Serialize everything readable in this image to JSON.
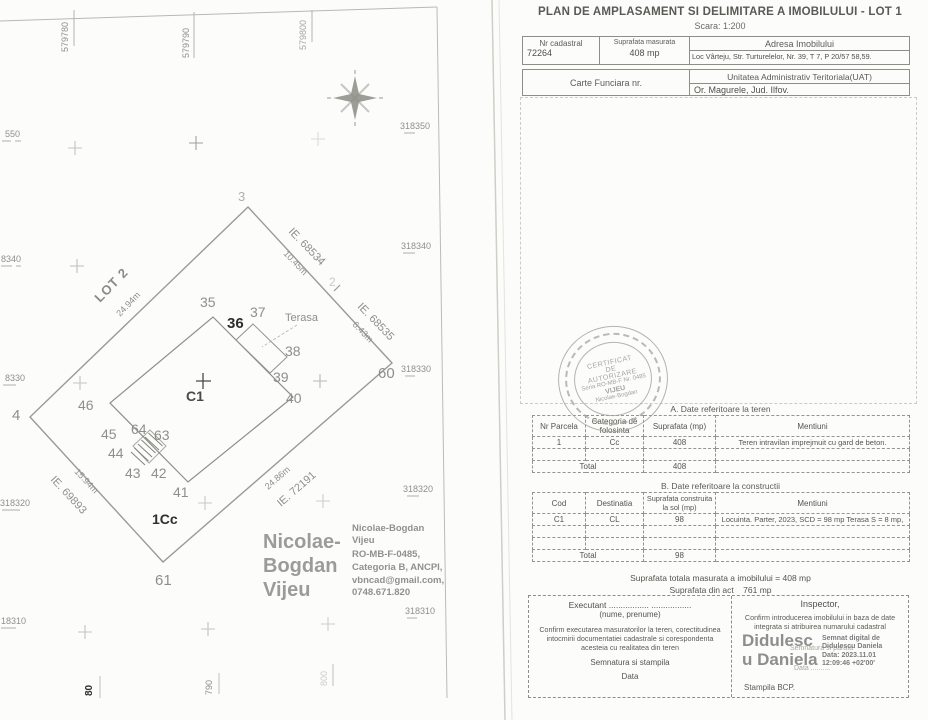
{
  "page": {
    "title": "PLAN DE AMPLASAMENT SI DELIMITARE A IMOBILULUI - LOT 1",
    "scale": "Scara: 1:200"
  },
  "header": {
    "nr_cadastral_label": "Nr cadastral",
    "nr_cadastral_value": "72264",
    "suprafata_masurata_label": "Suprafata masurata",
    "suprafata_masurata_value": "408 mp",
    "adresa_label": "Adresa Imobilului",
    "adresa_value": "Loc Vârteju, Str. Turturelelor, Nr. 39, T 7, P 20/57 58,59.",
    "carte_funciara_label": "Carte Funciara nr.",
    "uat_label": "Unitatea Administrativ Teritoriala(UAT)",
    "uat_value": "Or. Magurele, Jud. Ilfov."
  },
  "stamp": {
    "line1": "CERTIFICAT",
    "line2": "DE",
    "line3": "AUTORIZARE",
    "line4": "Seria RO-MB-F Nr. 0485",
    "line5": "VIJEU",
    "line6": "Nicolae-Bogdan"
  },
  "table_a": {
    "title": "A. Date referitoare la teren",
    "headers": [
      "Nr Parcela",
      "Categoria de folosinta",
      "Suprafata (mp)",
      "Mentiuni"
    ],
    "row": [
      "1",
      "Cc",
      "408",
      "Teren intravilan imprejmuit cu gard de beton."
    ],
    "total_label": "Total",
    "total_value": "408"
  },
  "table_b": {
    "title": "B. Date referitoare la constructii",
    "headers": [
      "Cod",
      "Destinatia",
      "Suprafata construita la sol (mp)",
      "Mentiuni"
    ],
    "row": [
      "C1",
      "CL",
      "98",
      "Locuinta. Parter, 2023, SCD = 98 mp Terasa S = 8 mp,"
    ],
    "total_label": "Total",
    "total_value": "98"
  },
  "totals": {
    "line1": "Suprafata totala masurata a imobilului = 408 mp",
    "line2_label": "Suprafata din act",
    "line2_value": "761 mp"
  },
  "executant": {
    "title_line": "Executant ................. .................",
    "name_hint": "(nume, prenume)",
    "confirm_text": "Confirm executarea masuratorilor la teren, corectitudinea intocmirii documentatiei cadastrale si corespondenta acesteia cu realitatea din teren",
    "sign_label": "Semnatura si stampila",
    "date_label": "Data"
  },
  "inspector": {
    "title": "Inspector,",
    "confirm_text": "Confirm introducerea imobilului in baza de date integrata si atribuirea numarului cadastral",
    "signature_name_line1": "Didulesc",
    "signature_name_line2": "u Daniela",
    "digital_line1": "Semnat digital de",
    "digital_line2": "Didulescu Daniela",
    "digital_line3": "Data: 2023.11.01",
    "digital_line4": "12:09:46 +02'00'",
    "sign_label": "Semnatura si parafa",
    "date_label": "Data ..........",
    "stamp_label": "Stampila BCP."
  },
  "plot": {
    "easting": [
      "579780",
      "579790",
      "579800"
    ],
    "easting_bottom": [
      "80",
      "790",
      "800"
    ],
    "northing_left": [
      "550",
      "8340",
      "8330",
      "318320",
      "18310"
    ],
    "northing_right": [
      "318350",
      "318340",
      "318330",
      "318320",
      "318310"
    ],
    "lot2": "LOT 2",
    "lot2_dim": "24.94m",
    "ie1": "IE. 68534",
    "ie1_dim": "10.45m",
    "ie2": "IE. 68535",
    "ie2_dim": "6.43m",
    "ie3": "IE. 72191",
    "ie3_dim": "24.86m",
    "ie4": "IE. 69893",
    "ie4_dim": "15.94m",
    "terasa": "Terasa",
    "c1": "C1",
    "cc": "1Cc",
    "pts": {
      "p2": "2",
      "p3": "3",
      "p4": "4",
      "p35": "35",
      "p36": "36",
      "p37": "37",
      "p38": "38",
      "p39": "39",
      "p40": "40",
      "p41": "41",
      "p42": "42",
      "p43": "43",
      "p44": "44",
      "p45": "45",
      "p46": "46",
      "p60": "60",
      "p61": "61",
      "p63": "63",
      "p64": "64"
    },
    "sig_big": [
      "Nicolae-",
      "Bogdan",
      "Vijeu"
    ],
    "sig_small": [
      "Nicolae-Bogdan",
      "Vijeu",
      "RO-MB-F-0485,",
      "Categoria B, ANCPI,",
      "vbncad@gmail.com,",
      "0748.671.820"
    ]
  }
}
